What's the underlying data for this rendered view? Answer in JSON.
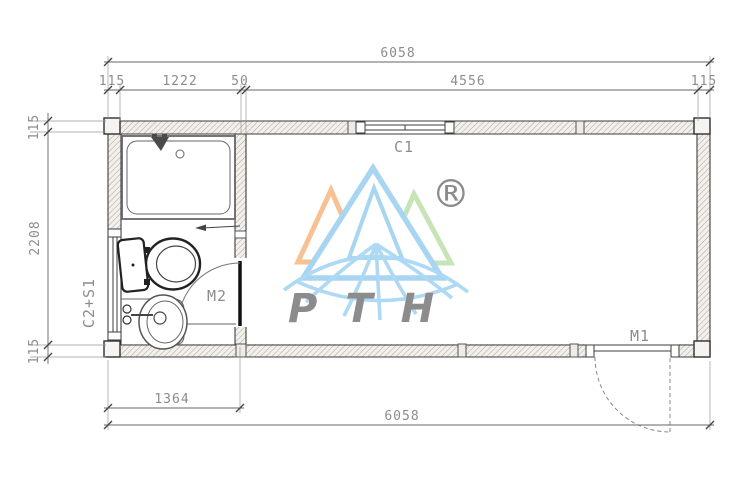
{
  "drawing": {
    "type": "container-house-floor-plan",
    "dimensions": {
      "top_total": "6058",
      "top_segments": [
        "115",
        "1222",
        "50",
        "4556",
        "115"
      ],
      "left_segments": [
        "115",
        "2208",
        "115"
      ],
      "bottom_partition": "1364",
      "bottom_total": "6058"
    },
    "labels": {
      "window_top": "C1",
      "interior_door": "M2",
      "exterior_door": "M1",
      "left_window": "C2+S1"
    },
    "logo": {
      "brand": "PTH",
      "registered_mark": "®",
      "colors": {
        "orange": "#f7c193",
        "blue": "#a8d5f2",
        "green": "#c6e4b6",
        "text_blue": "#c9e5f8",
        "gray": "#cdcdcd"
      }
    }
  }
}
